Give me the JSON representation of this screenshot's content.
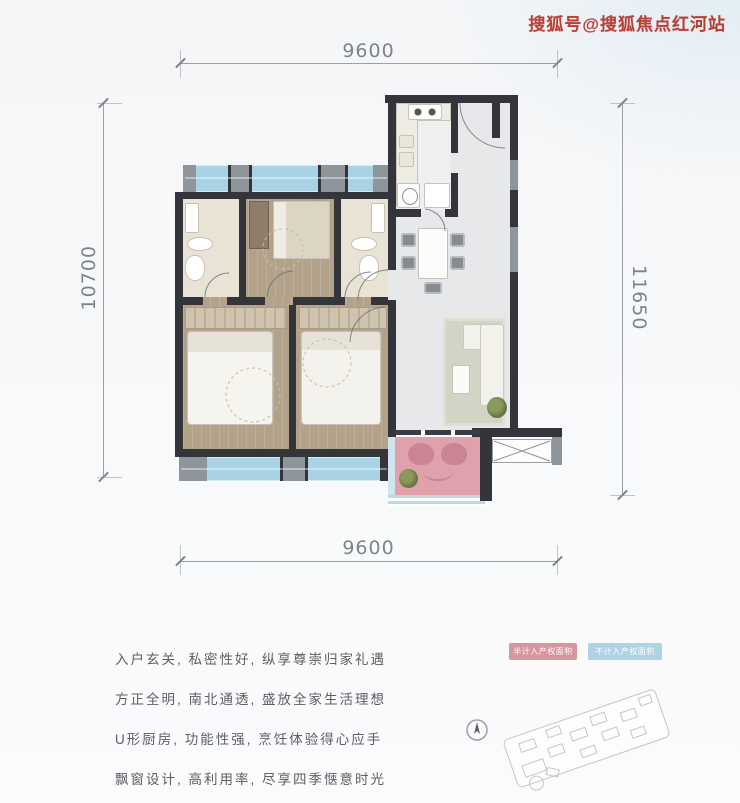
{
  "watermark": {
    "text": "搜狐号@搜狐焦点红河站"
  },
  "dimensions": {
    "top": "9600",
    "bottom": "9600",
    "left": "10700",
    "right": "11650"
  },
  "description_lines": [
    "入户玄关, 私密性好, 纵享尊崇归家礼遇",
    "方正全明, 南北通透, 盛放全家生活理想",
    "U形厨房, 功能性强, 烹饪体验得心应手",
    "飘窗设计, 高利用率, 尽享四季惬意时光"
  ],
  "legend": [
    {
      "label": "半计入产权面积",
      "color": "#d48e98"
    },
    {
      "label": "不计入产权面积",
      "color": "#a9cfe3"
    }
  ],
  "colors": {
    "wall": "#33353b",
    "col": "#8e959b",
    "bay": "#a9d2e5",
    "balcony": "#dfa2ac",
    "seat": "#ca8593",
    "wood": "#b3a28a",
    "bath": "#e9e3d5",
    "floor": "#e7e8ea",
    "rug": "#d0d5c5",
    "dim": "#9aa0a5",
    "wm": "#b23328",
    "legend1": "#d48e98",
    "legend2": "#a9cfe3"
  }
}
